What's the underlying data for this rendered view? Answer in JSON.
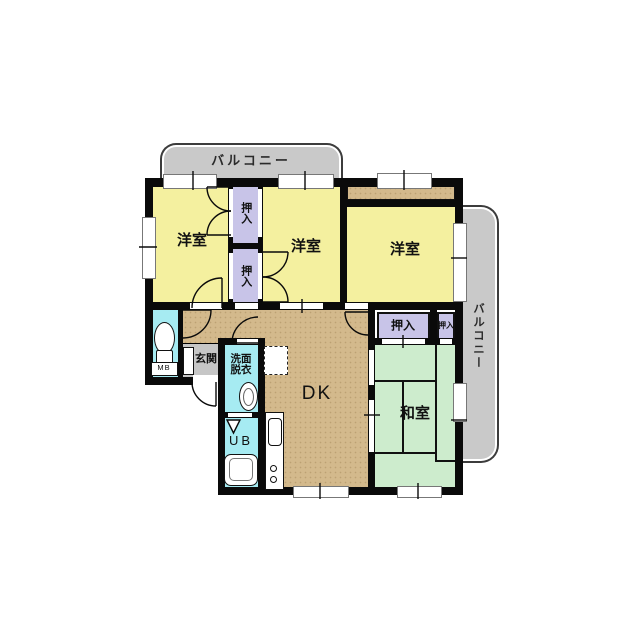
{
  "floorplan_type": "apartment-madori",
  "balconies": {
    "top": "バルコニー",
    "right": "バルコニー"
  },
  "rooms": {
    "western_room_1": "洋室",
    "western_room_2": "洋室",
    "western_room_3": "洋室",
    "dining_kitchen": "DK",
    "japanese_room": "和室",
    "entrance": "玄関",
    "washroom_line1": "洗面",
    "washroom_line2": "脱衣",
    "unit_bath": "UB",
    "meter_box": "MB"
  },
  "closets": {
    "between_top": "押入",
    "between_bottom": "押入",
    "japanese_large": "押入",
    "japanese_small": "押入"
  },
  "colors": {
    "western_room": "#f4f09f",
    "closet": "#c8c4e8",
    "dk_and_hall": "#d3b98c",
    "japanese_room": "#cdeccd",
    "wet_area": "#a6ebf2",
    "entrance_floor": "#c6c6c6",
    "balcony": "#c9c9c9",
    "wall": "#0a0a0a",
    "background": "#ffffff"
  }
}
